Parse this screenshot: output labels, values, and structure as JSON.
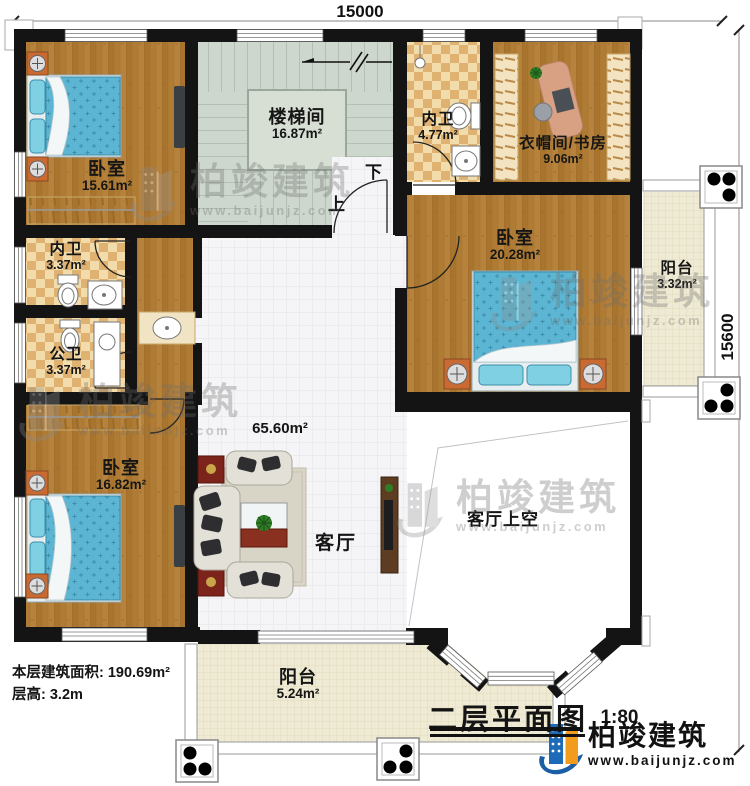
{
  "dimensions": {
    "top": "15000",
    "right": "15600"
  },
  "rooms": {
    "stairwell": {
      "name": "楼梯间",
      "area": "16.87m²"
    },
    "bath_top": {
      "name": "内卫",
      "area": "4.77m²"
    },
    "cloak_study": {
      "name": "衣帽间/书房",
      "area": "9.06m²"
    },
    "bedroom_tl": {
      "name": "卧室",
      "area": "15.61m²"
    },
    "bedroom_right": {
      "name": "卧室",
      "area": "20.28m²"
    },
    "balcony_right": {
      "name": "阳台",
      "area": "3.32m²"
    },
    "bath_left": {
      "name": "内卫",
      "area": "3.37m²"
    },
    "bath_public": {
      "name": "公卫",
      "area": "3.37m²"
    },
    "bedroom_bl": {
      "name": "卧室",
      "area": "16.82m²"
    },
    "living": {
      "name": "客厅",
      "area": "65.60m²"
    },
    "living_void": {
      "name": "客厅上空"
    },
    "balcony_bottom": {
      "name": "阳台",
      "area": "5.24m²"
    }
  },
  "stairs": {
    "up": "上",
    "down": "下"
  },
  "footer": {
    "floor_area": "本层建筑面积: 190.69m²",
    "floor_height": "层高: 3.2m"
  },
  "title_block": {
    "title": "二层平面图",
    "scale": "1:80"
  },
  "brand": {
    "name": "柏竣建筑",
    "url": "www.baijunjz.com"
  },
  "watermark": {
    "name": "柏竣建筑",
    "url": "www.baijunjz.com"
  },
  "colors": {
    "wall": "#141414",
    "wood": "#b07c35",
    "stair_floor": "#cdd7cd",
    "tile_checker": "#e3b678",
    "living_tile": "#f5f5f7",
    "balcony_tile": "#eeead3",
    "bed": "#5cb6d3",
    "nightstand": "#c96a33",
    "side_table": "#7c241c",
    "brand_blue": "#1b62ab",
    "brand_orange": "#f29c1e"
  }
}
